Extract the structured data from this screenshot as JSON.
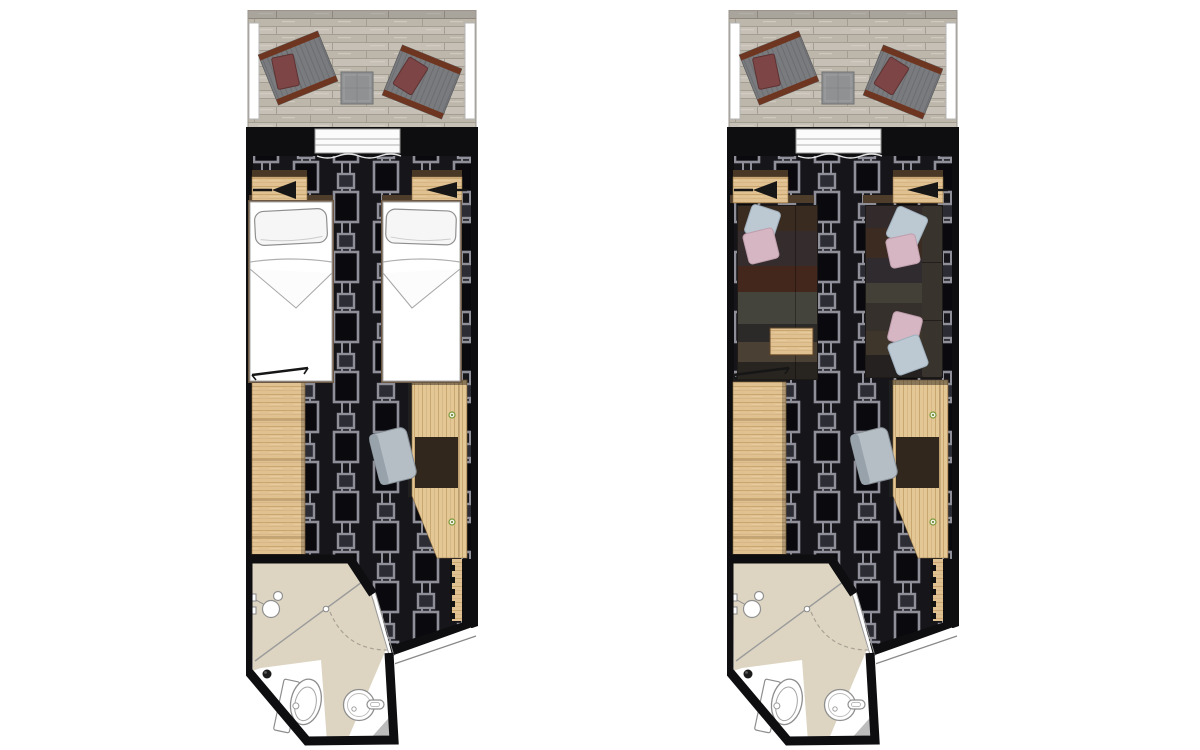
{
  "canvas": {
    "width": 1200,
    "height": 750,
    "background": "#ffffff"
  },
  "plans": [
    {
      "id": "plan-night",
      "label": "Stateroom floor plan - twin beds night configuration",
      "furniture": [
        "balcony deck",
        "balcony armchair",
        "balcony armchair",
        "balcony table",
        "sliding balcony door",
        "nightstand with reading lamp",
        "nightstand with reading lamp",
        "twin bed",
        "twin bed",
        "wall mounted tv",
        "wardrobe",
        "desk",
        "desk chair",
        "entry door",
        "bathroom",
        "shower",
        "toilet",
        "washbasin"
      ]
    },
    {
      "id": "plan-day",
      "label": "Stateroom floor plan - sofas day configuration",
      "furniture": [
        "balcony deck",
        "balcony armchair",
        "balcony armchair",
        "balcony table",
        "sliding balcony door",
        "nightstand with reading lamp",
        "nightstand with reading lamp",
        "sofa with pillows",
        "sofa with pillows and backrest",
        "coffee table",
        "wall mounted tv",
        "wardrobe",
        "desk",
        "desk chair",
        "entry door",
        "bathroom",
        "shower",
        "toilet",
        "washbasin"
      ]
    }
  ],
  "colors": {
    "page-bg": "#ffffff",
    "deck": "#c6c0b6",
    "deck-dark": "#bdb6ab",
    "deck-seam": "#a49d91",
    "wall": "#0e0e10",
    "carpet-bg": "#15151a",
    "carpet-line": "#8f8f99",
    "carpet-block": "#0a0a0e",
    "carpet-square": "#2c2c34",
    "wood": "#e0c292",
    "wood-grain": "#c49e66",
    "bed-frame": "#6b5742",
    "headboard": "#4f3d2c",
    "bedding": "#ffffff",
    "pillow-white": "#f6f6f6",
    "chair-gray": "#797b7e",
    "chair-trim": "#6e3620",
    "cushion-red": "#7d4545",
    "table-gray": "#8f9193",
    "desk-mat": "#32271d",
    "desk-chair": "#b6bec5",
    "desk-chair-back": "#98a2aa",
    "outlet-green": "#7a9a3a",
    "bath-floor": "#ddd5c2",
    "bath-tile": "#bcbcbc",
    "fixture-white": "#ffffff",
    "pillow-blue": "#bcc9d3",
    "pillow-pink": "#d5b6c2",
    "sofa-border": "#1e1a17",
    "sofa-backrest": "#39332e",
    "sofa1-bands": [
      "#3a2b21",
      "#352c2e",
      "#43261c",
      "#45443c",
      "#2b2a28",
      "#4a4034",
      "#282420"
    ],
    "sofa2-bands": [
      "#332a2b",
      "#3b2b20",
      "#2f2b2f",
      "#434038",
      "#35302b",
      "#3e352b",
      "#252120"
    ]
  }
}
